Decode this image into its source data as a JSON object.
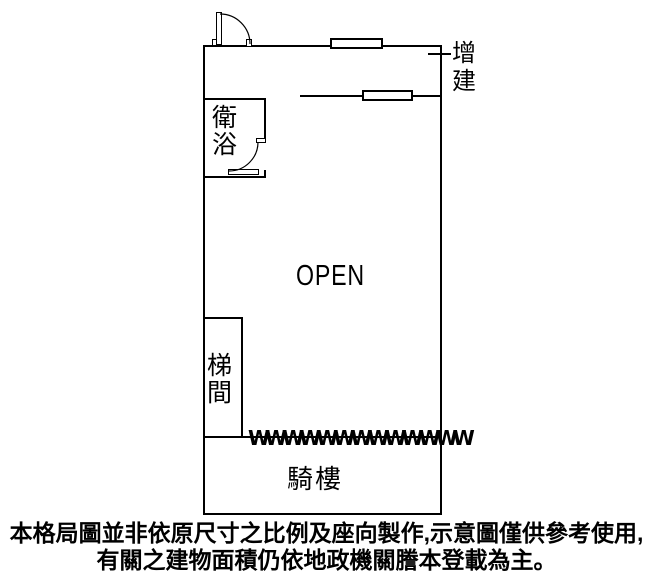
{
  "plan": {
    "open_label": "OPEN",
    "extension_label": "增\n建",
    "bathroom_label": "衛\n浴",
    "stairwell_label": "梯\n間",
    "arcade_label": "騎樓",
    "corrugated_wall": "WWWWWWWWWWWWW"
  },
  "disclaimer": {
    "line1": "本格局圖並非依原尺寸之比例及座向製作,示意圖僅供參考使用,",
    "line2": "有關之建物面積仍依地政機關謄本登載為主。"
  },
  "colors": {
    "line": "#000000",
    "text": "#000000",
    "background": "#ffffff"
  }
}
